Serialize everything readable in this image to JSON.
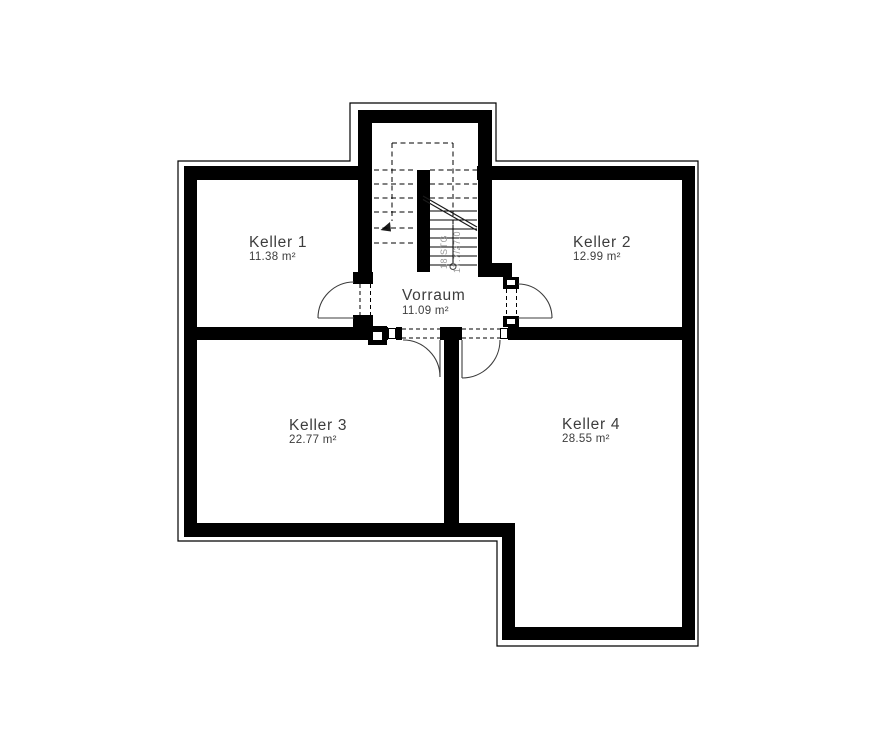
{
  "plan": {
    "rooms": [
      {
        "name": "Keller 1",
        "area": "11.38 m²"
      },
      {
        "name": "Keller 2",
        "area": "12.99 m²"
      },
      {
        "name": "Vorraum",
        "area": "11.09 m²"
      },
      {
        "name": "Keller 3",
        "area": "22.77 m²"
      },
      {
        "name": "Keller 4",
        "area": "28.55 m²"
      }
    ],
    "stair": {
      "steps_label": "18 STG",
      "rise_run_label": "17.7/27.0"
    },
    "colors": {
      "walls": "#000000",
      "background": "#ffffff",
      "room_label": "#3d3d3d",
      "stair_label": "#9a9a9a"
    }
  }
}
